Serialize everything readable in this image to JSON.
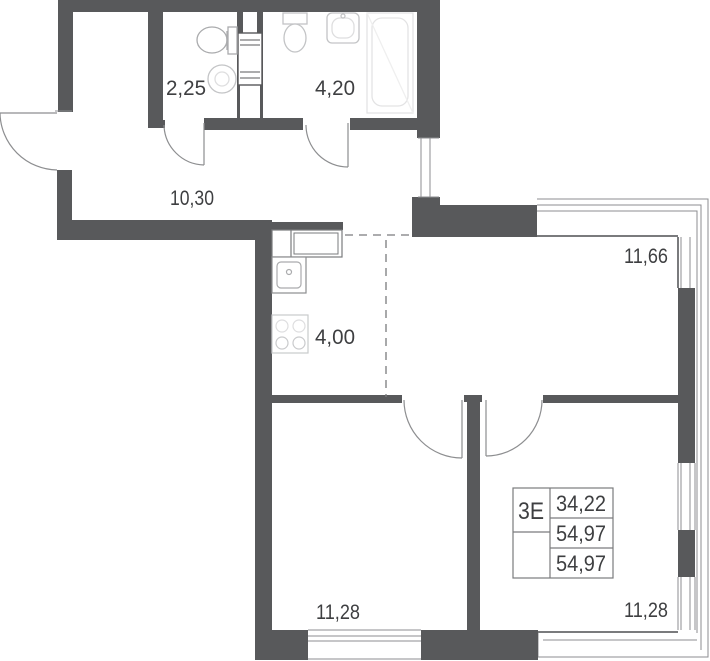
{
  "rooms": [
    {
      "id": "wc",
      "area": "2,25"
    },
    {
      "id": "bathroom",
      "area": "4,20"
    },
    {
      "id": "hallway",
      "area": "10,30"
    },
    {
      "id": "living-room",
      "area": "11,66"
    },
    {
      "id": "kitchen",
      "area": "4,00"
    },
    {
      "id": "bedroom-left",
      "area": "11,28"
    },
    {
      "id": "bedroom-right",
      "area": "11,28"
    }
  ],
  "stamp": {
    "type_label": "3Е",
    "rows": [
      "34,22",
      "54,97",
      "54,97"
    ]
  },
  "colors": {
    "wall": "#58595b",
    "thin_line": "#7a7b7d",
    "fixture": "#a9aaac",
    "faint_fixture": "#dededf",
    "text": "#3e3f41"
  }
}
